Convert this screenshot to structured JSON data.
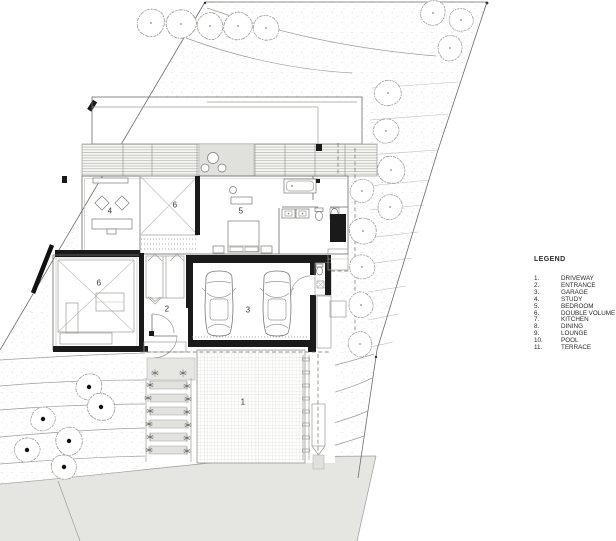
{
  "document": {
    "type_label": "site floor plan"
  },
  "colors": {
    "paper": "#ffffff",
    "ink": "#2a2a2a",
    "wall": "#1a1a1a",
    "line": "#6b6b67",
    "road": "#e5e5e1",
    "panel": "#e0e0dc"
  },
  "plan": {
    "labels": [
      {
        "text": "4",
        "room": "study"
      },
      {
        "text": "6",
        "room": "double-volume-upper"
      },
      {
        "text": "5",
        "room": "bedroom"
      },
      {
        "text": "6",
        "room": "double-volume-lower"
      },
      {
        "text": "2",
        "room": "entrance"
      },
      {
        "text": "3",
        "room": "garage"
      },
      {
        "text": "1",
        "room": "driveway"
      }
    ]
  },
  "legend": {
    "title": "LEGEND",
    "items": [
      {
        "num": "1.",
        "label": "DRIVEWAY"
      },
      {
        "num": "2.",
        "label": "ENTRANCE"
      },
      {
        "num": "3.",
        "label": "GARAGE"
      },
      {
        "num": "4.",
        "label": "STUDY"
      },
      {
        "num": "5.",
        "label": "BEDROOM"
      },
      {
        "num": "6.",
        "label": "DOUBLE VOLUME"
      },
      {
        "num": "7.",
        "label": "KITCHEN"
      },
      {
        "num": "8.",
        "label": "DINING"
      },
      {
        "num": "9.",
        "label": "LOUNGE"
      },
      {
        "num": "10.",
        "label": "POOL"
      },
      {
        "num": "11.",
        "label": "TERRACE"
      }
    ]
  }
}
